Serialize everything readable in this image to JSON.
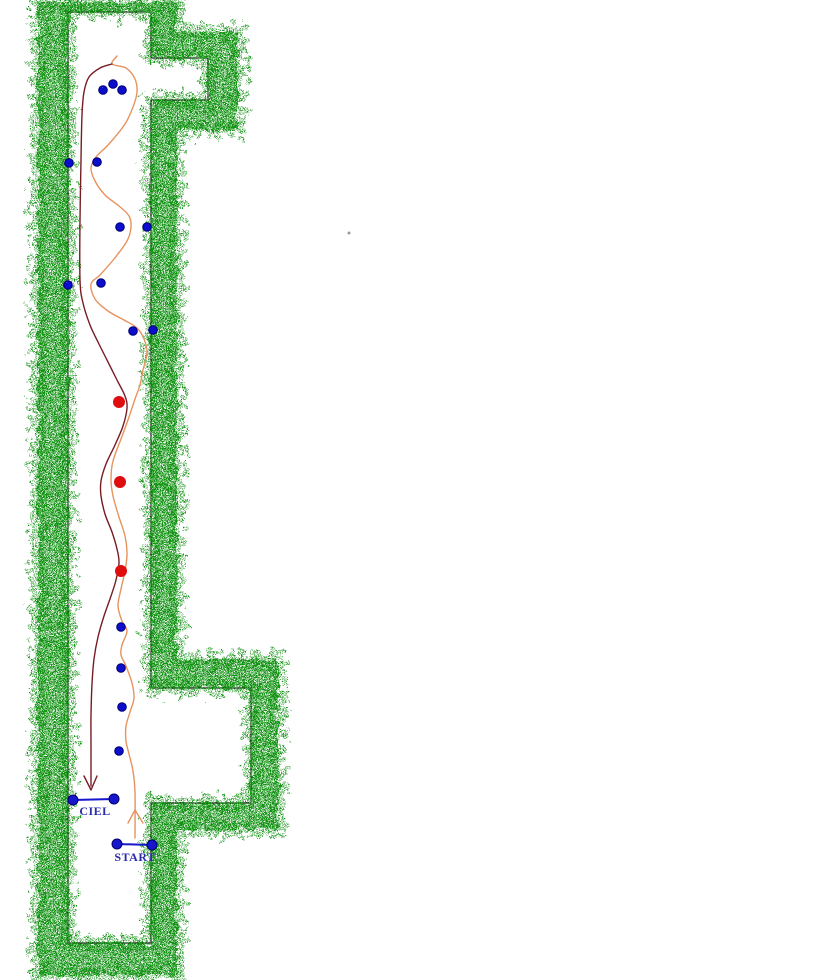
{
  "diagram": {
    "title": "course-trajectory-map"
  },
  "colors": {
    "background": "#ffffff",
    "wall_green": "#149414",
    "wall_outline": "#1a1a1a",
    "blue_dot": "#0a0ace",
    "blue_dot_edge": "#000070",
    "red_dot": "#df1111",
    "outbound_path": "#e6935f",
    "return_path": "#761d24",
    "gate_blue": "#1616cd",
    "label_navy": "#2b2bb0",
    "speck": "#9a9a9a"
  },
  "walls": {
    "outer": [
      [
        38,
        2
      ],
      [
        177,
        2
      ],
      [
        177,
        32
      ],
      [
        238,
        32
      ],
      [
        238,
        130
      ],
      [
        177,
        130
      ],
      [
        177,
        660
      ],
      [
        278,
        660
      ],
      [
        278,
        830
      ],
      [
        177,
        830
      ],
      [
        177,
        975
      ],
      [
        38,
        975
      ]
    ],
    "inner": [
      [
        68,
        12
      ],
      [
        151,
        12
      ],
      [
        151,
        58
      ],
      [
        208,
        58
      ],
      [
        208,
        100
      ],
      [
        151,
        100
      ],
      [
        151,
        688
      ],
      [
        251,
        688
      ],
      [
        251,
        803
      ],
      [
        151,
        803
      ],
      [
        151,
        943
      ],
      [
        68,
        943
      ]
    ]
  },
  "gates": [
    {
      "label": "CIEL",
      "x1": 73,
      "y1": 800,
      "x2": 114,
      "y2": 799,
      "label_x": 95,
      "label_y": 815
    },
    {
      "label": "START",
      "x1": 117,
      "y1": 844,
      "x2": 152,
      "y2": 845,
      "label_x": 135,
      "label_y": 861
    }
  ],
  "blue_dots": [
    [
      103,
      90
    ],
    [
      113,
      84
    ],
    [
      122,
      90
    ],
    [
      69,
      163
    ],
    [
      97,
      162
    ],
    [
      120,
      227
    ],
    [
      147,
      227
    ],
    [
      68,
      285
    ],
    [
      101,
      283
    ],
    [
      133,
      331
    ],
    [
      153,
      330
    ],
    [
      121,
      627
    ],
    [
      121,
      668
    ],
    [
      122,
      707
    ],
    [
      119,
      751
    ]
  ],
  "red_dots": [
    [
      119,
      402
    ],
    [
      120,
      482
    ],
    [
      121,
      571
    ]
  ],
  "trajectories": {
    "outbound": {
      "name": "start-to-top-path",
      "points": [
        [
          117,
          56
        ],
        [
          112,
          64
        ],
        [
          126,
          68
        ],
        [
          135,
          79
        ],
        [
          137,
          92
        ],
        [
          133,
          107
        ],
        [
          125,
          124
        ],
        [
          109,
          144
        ],
        [
          96,
          157
        ],
        [
          91,
          168
        ],
        [
          95,
          181
        ],
        [
          105,
          195
        ],
        [
          119,
          206
        ],
        [
          129,
          216
        ],
        [
          131,
          227
        ],
        [
          127,
          241
        ],
        [
          114,
          259
        ],
        [
          100,
          275
        ],
        [
          91,
          284
        ],
        [
          95,
          299
        ],
        [
          108,
          311
        ],
        [
          124,
          320
        ],
        [
          137,
          328
        ],
        [
          144,
          339
        ],
        [
          147,
          353
        ],
        [
          143,
          370
        ],
        [
          140,
          385
        ],
        [
          135,
          399
        ],
        [
          129,
          417
        ],
        [
          121,
          439
        ],
        [
          113,
          461
        ],
        [
          111,
          479
        ],
        [
          113,
          496
        ],
        [
          119,
          517
        ],
        [
          125,
          536
        ],
        [
          127,
          554
        ],
        [
          125,
          571
        ],
        [
          121,
          589
        ],
        [
          118,
          606
        ],
        [
          122,
          621
        ],
        [
          127,
          631
        ],
        [
          122,
          645
        ],
        [
          121,
          655
        ],
        [
          126,
          666
        ],
        [
          132,
          683
        ],
        [
          134,
          698
        ],
        [
          130,
          712
        ],
        [
          126,
          726
        ],
        [
          126,
          741
        ],
        [
          129,
          754
        ],
        [
          133,
          771
        ],
        [
          135,
          792
        ],
        [
          135,
          838
        ]
      ],
      "arrow": {
        "tip": [
          135,
          810
        ],
        "left": [
          128,
          823
        ],
        "right": [
          143,
          823
        ]
      }
    },
    "return": {
      "name": "top-to-ciel-path",
      "points": [
        [
          112,
          64
        ],
        [
          100,
          68
        ],
        [
          89,
          77
        ],
        [
          84,
          92
        ],
        [
          82,
          115
        ],
        [
          81,
          160
        ],
        [
          80,
          220
        ],
        [
          80,
          280
        ],
        [
          83,
          303
        ],
        [
          90,
          325
        ],
        [
          98,
          342
        ],
        [
          107,
          360
        ],
        [
          117,
          380
        ],
        [
          125,
          396
        ],
        [
          127,
          408
        ],
        [
          123,
          426
        ],
        [
          115,
          445
        ],
        [
          106,
          464
        ],
        [
          101,
          481
        ],
        [
          101,
          496
        ],
        [
          105,
          514
        ],
        [
          112,
          532
        ],
        [
          117,
          549
        ],
        [
          119,
          563
        ],
        [
          116,
          580
        ],
        [
          111,
          596
        ],
        [
          104,
          616
        ],
        [
          98,
          637
        ],
        [
          94,
          659
        ],
        [
          92,
          684
        ],
        [
          91,
          715
        ],
        [
          91,
          748
        ],
        [
          91,
          786
        ]
      ],
      "arrow": {
        "tip": [
          91,
          790
        ],
        "left": [
          84,
          776
        ],
        "right": [
          97,
          776
        ]
      }
    }
  },
  "speck": {
    "x": 349,
    "y": 233
  }
}
